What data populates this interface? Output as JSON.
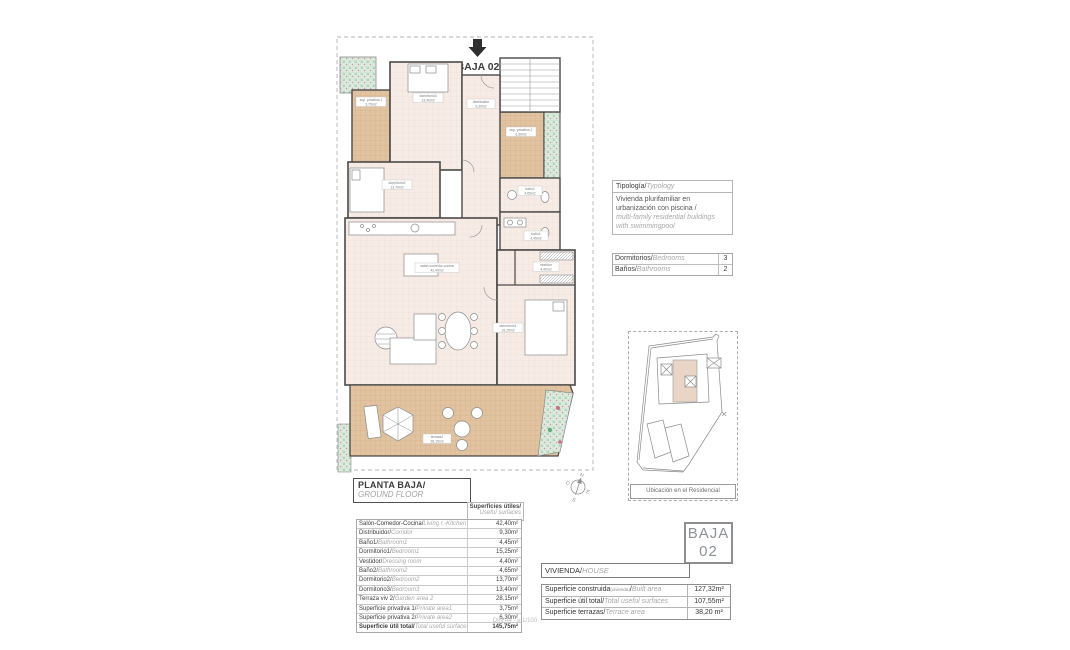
{
  "plan": {
    "entrance_label": "BAJA 02",
    "rooms": [
      {
        "name": "sup. privativa 1",
        "area": "3,75m2"
      },
      {
        "name": "dormitorio3",
        "area": "13,40m2"
      },
      {
        "name": "distribuidor",
        "area": "9,30m2"
      },
      {
        "name": "sup. privativa 2",
        "area": "6,30m2"
      },
      {
        "name": "dormitorio2",
        "area": "13,70m2"
      },
      {
        "name": "baño2",
        "area": "4,65m2"
      },
      {
        "name": "baño1",
        "area": "4,45m2"
      },
      {
        "name": "salón-comedor-cocina",
        "area": "42,40m2"
      },
      {
        "name": "vestidor",
        "area": "4,40m2"
      },
      {
        "name": "dormitorio1",
        "area": "15,25m2"
      },
      {
        "name": "terraza2",
        "area": "28,15m2"
      }
    ],
    "compass": {
      "n": "N",
      "s": "S",
      "e": "E",
      "o": "O"
    }
  },
  "typology": {
    "header_es": "Tipología/",
    "header_en": "Typology",
    "line1_es": "Vivienda plurifamiliar en",
    "line2_es": "urbanización con piscina  /",
    "line3_en": "multi-family residential buildings",
    "line4_en": "with swimmingpool",
    "rows": [
      {
        "es": "Dormitorios/",
        "en": "Bedrooms",
        "value": "3"
      },
      {
        "es": "Baños/",
        "en": "Bathrooms",
        "value": "2"
      }
    ]
  },
  "site_map": {
    "caption": "Ubicación en el Residencial"
  },
  "floor_title": {
    "es": "PLANTA BAJA/",
    "en": "GROUND FLOOR"
  },
  "useful": {
    "header_es": "Superficies útiles/",
    "header_en": "Useful surfaces",
    "rows": [
      {
        "es": "Salón-Comedor-Cocina/",
        "en": "Living r.-Kitchen",
        "value": "42,40m²"
      },
      {
        "es": "Distribuidor/",
        "en": "Corridor",
        "value": "9,30m²"
      },
      {
        "es": "Baño1/",
        "en": "Bathroom1",
        "value": "4,45m²"
      },
      {
        "es": "Dormitorio1/",
        "en": "Bedroom1",
        "value": "15,25m²"
      },
      {
        "es": "Vestidor/",
        "en": "Dressing room",
        "value": "4,40m²"
      },
      {
        "es": "Baño2/",
        "en": "Bathroom2",
        "value": "4,65m²"
      },
      {
        "es": "Dormitorio2/",
        "en": "Bedroom2",
        "value": "13,70m²"
      },
      {
        "es": "Dormitorio3/",
        "en": "Bedroom3",
        "value": "13,40m²"
      },
      {
        "es": "Terraza viv 2/",
        "en": "Garden area 2",
        "value": "28,15m²"
      },
      {
        "es": "Superficie privativa 1/",
        "en": "Private area1",
        "value": "3,75m²"
      },
      {
        "es": "Superficie privativa 2/",
        "en": "Private area2",
        "value": "6,30m²"
      },
      {
        "es": "Superficie útil total/",
        "en": "Total useful surface",
        "value": "145,75m²"
      }
    ]
  },
  "unit_badge": {
    "line1": "BAJA",
    "line2": "02"
  },
  "house": {
    "header_es": "VIVIENDA/",
    "header_en": "HOUSE",
    "rows": [
      {
        "es": "Superficie construida",
        "sub": "(vivienda)",
        "slash": "/",
        "en": "Built area",
        "value": "127,32m²"
      },
      {
        "es": "Superficie útil total/",
        "sub": "",
        "slash": "",
        "en": "Total useful surfaces",
        "value": "107,55m²"
      },
      {
        "es": "Superficie terrazas/",
        "sub": "",
        "slash": "",
        "en": "Terrace area",
        "value": "38,20 m²"
      }
    ]
  },
  "footer_note": "DIN A4 - e 1/100"
}
